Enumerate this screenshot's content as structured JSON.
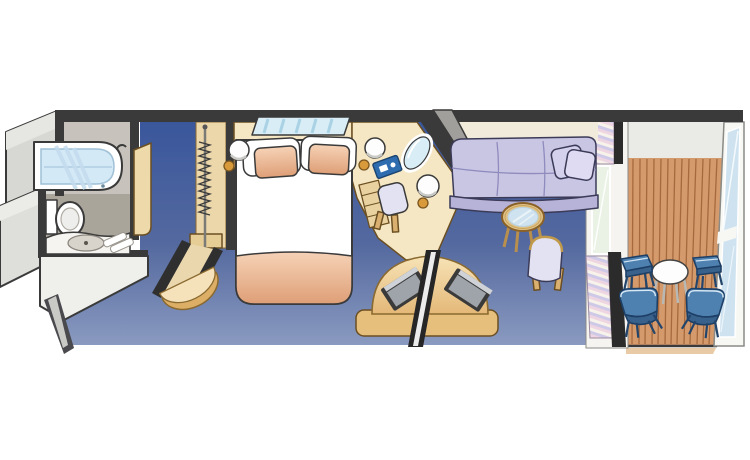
{
  "scene": {
    "type": "floor-plan",
    "subject": "cruise-ship-stateroom-with-private-balcony"
  },
  "canvas": {
    "width": 750,
    "height": 460
  },
  "colors": {
    "wall_dark": "#3a3a3a",
    "wall_gray": "#a09f9b",
    "exterior_gray": "#d7d7d3",
    "carpet_top": "#3a579c",
    "carpet_bottom": "#8a9ac0",
    "cream": "#f5e7c4",
    "cream_light": "#f1ebdc",
    "tan": "#ecd7ab",
    "tan_dark": "#dcaa5e",
    "wood_deck": "#d49a6c",
    "wood_line": "#a5693d",
    "sofa": "#c9c6e4",
    "sofa_shadow": "#b7b3d8",
    "upholstery": "#e3e2f2",
    "peach": "#f0c3a4",
    "bed_white": "#ffffff",
    "bath_floor": "#aaa59b",
    "bath_wall": "#c7c3bc",
    "tub_water": "#d3e9f6",
    "window_glass": "#d8edf6",
    "glass_rail": "#cfe2ef",
    "balcony_ceiling": "#eaeae6",
    "chair_blue": "#4f81b0",
    "chair_blue_dark": "#23456b",
    "tv_screen": "#9fa4aa",
    "gold": "#d99a3c",
    "curtain_pink": "#eed5e2",
    "curtain_lavender": "#cfc9e8",
    "divider_glass": "#e9f2e4",
    "table_white": "#fdfdfd",
    "folder_blue": "#2e6cb0"
  },
  "rooms": [
    {
      "id": "bathroom",
      "furniture": [
        "bathtub",
        "shower-streaks",
        "faucet",
        "toilet",
        "sink-counter",
        "sink-basin",
        "towels"
      ]
    },
    {
      "id": "entry-hall",
      "furniture": [
        "bathroom-door",
        "entry-door-arc"
      ]
    },
    {
      "id": "closet",
      "furniture": [
        "hanger-rod",
        "hangers",
        "shelf"
      ]
    },
    {
      "id": "bedroom",
      "furniture": [
        "queen-bed",
        "duvet",
        "foot-blanket",
        "pillows",
        "headboard-window",
        "nightstands",
        "wall-lamps",
        "desk",
        "desk-drawers",
        "desk-chair",
        "mirror",
        "blue-folder"
      ]
    },
    {
      "id": "sitting-area",
      "furniture": [
        "sofa",
        "sofa-pillows",
        "glass-coffee-table",
        "side-chair",
        "tv-cabinet",
        "tv-left",
        "tv-right"
      ]
    },
    {
      "id": "balcony",
      "furniture": [
        "round-table",
        "footstool-left",
        "footstool-right",
        "deck-chair-left",
        "deck-chair-right",
        "glass-railing",
        "privacy-divider",
        "curtains",
        "wood-decking"
      ]
    }
  ]
}
